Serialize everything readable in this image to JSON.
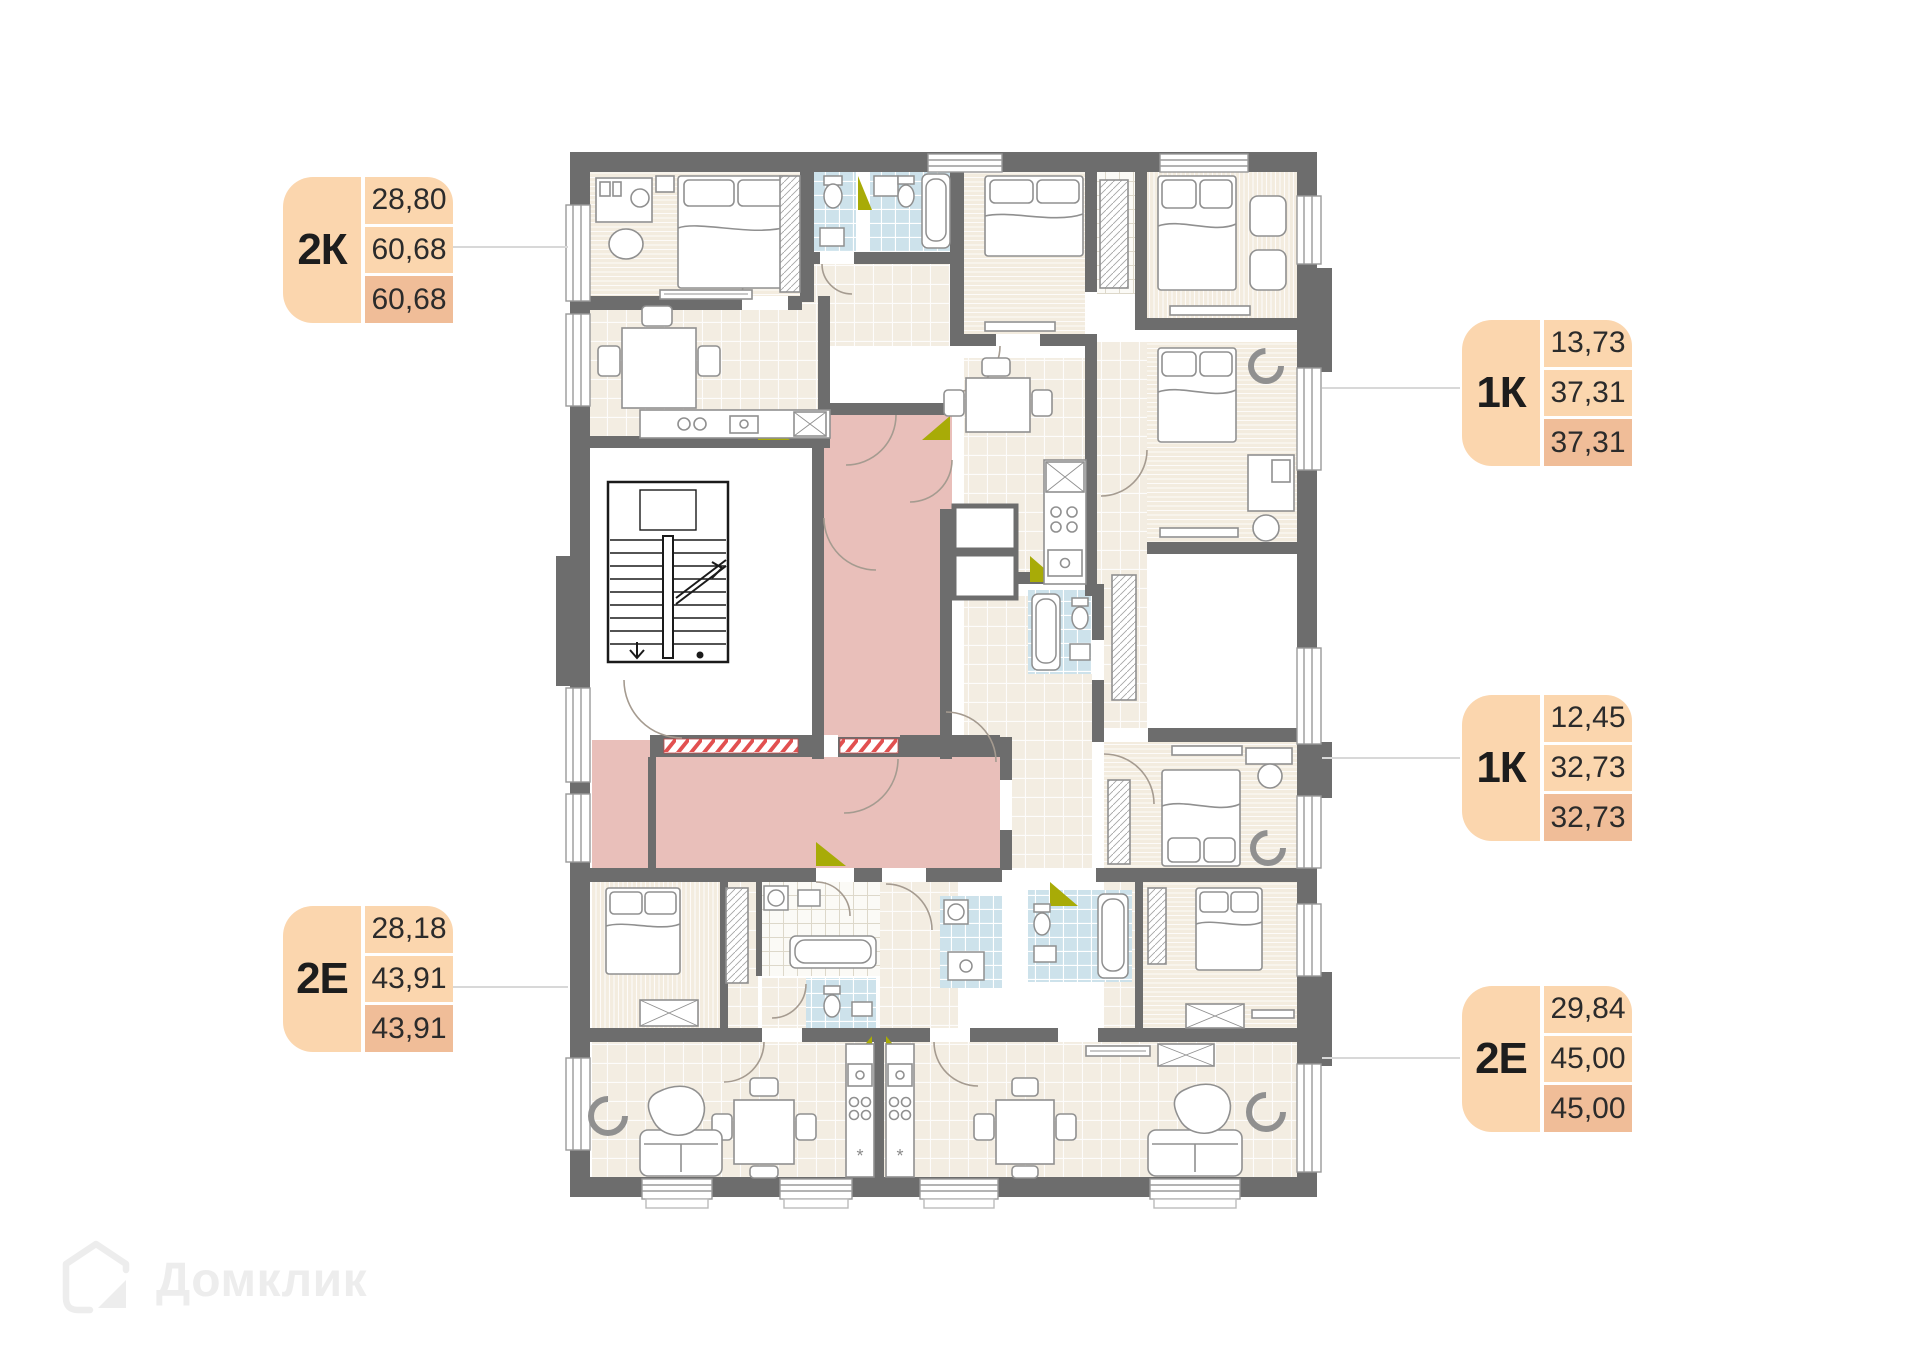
{
  "watermark": {
    "text": "Домклик"
  },
  "colors": {
    "label_light": "#FBD6AE",
    "label_dark": "#F0BD98",
    "corridor_pink": "#E9BFBA",
    "bathroom_blue": "#CDE2EB",
    "wall_gray": "#6D6D6D",
    "floor_cream": "#F3EDE2",
    "entry_door_olive": "#A8AB07"
  },
  "apartments": [
    {
      "type": "2К",
      "values": [
        "28,80",
        "60,68",
        "60,68"
      ],
      "side": "left"
    },
    {
      "type": "1К",
      "values": [
        "13,73",
        "37,31",
        "37,31"
      ],
      "side": "right"
    },
    {
      "type": "1К",
      "values": [
        "12,45",
        "32,73",
        "32,73"
      ],
      "side": "right"
    },
    {
      "type": "2Е",
      "values": [
        "28,18",
        "43,91",
        "43,91"
      ],
      "side": "left"
    },
    {
      "type": "2Е",
      "values": [
        "29,84",
        "45,00",
        "45,00"
      ],
      "side": "right"
    }
  ]
}
